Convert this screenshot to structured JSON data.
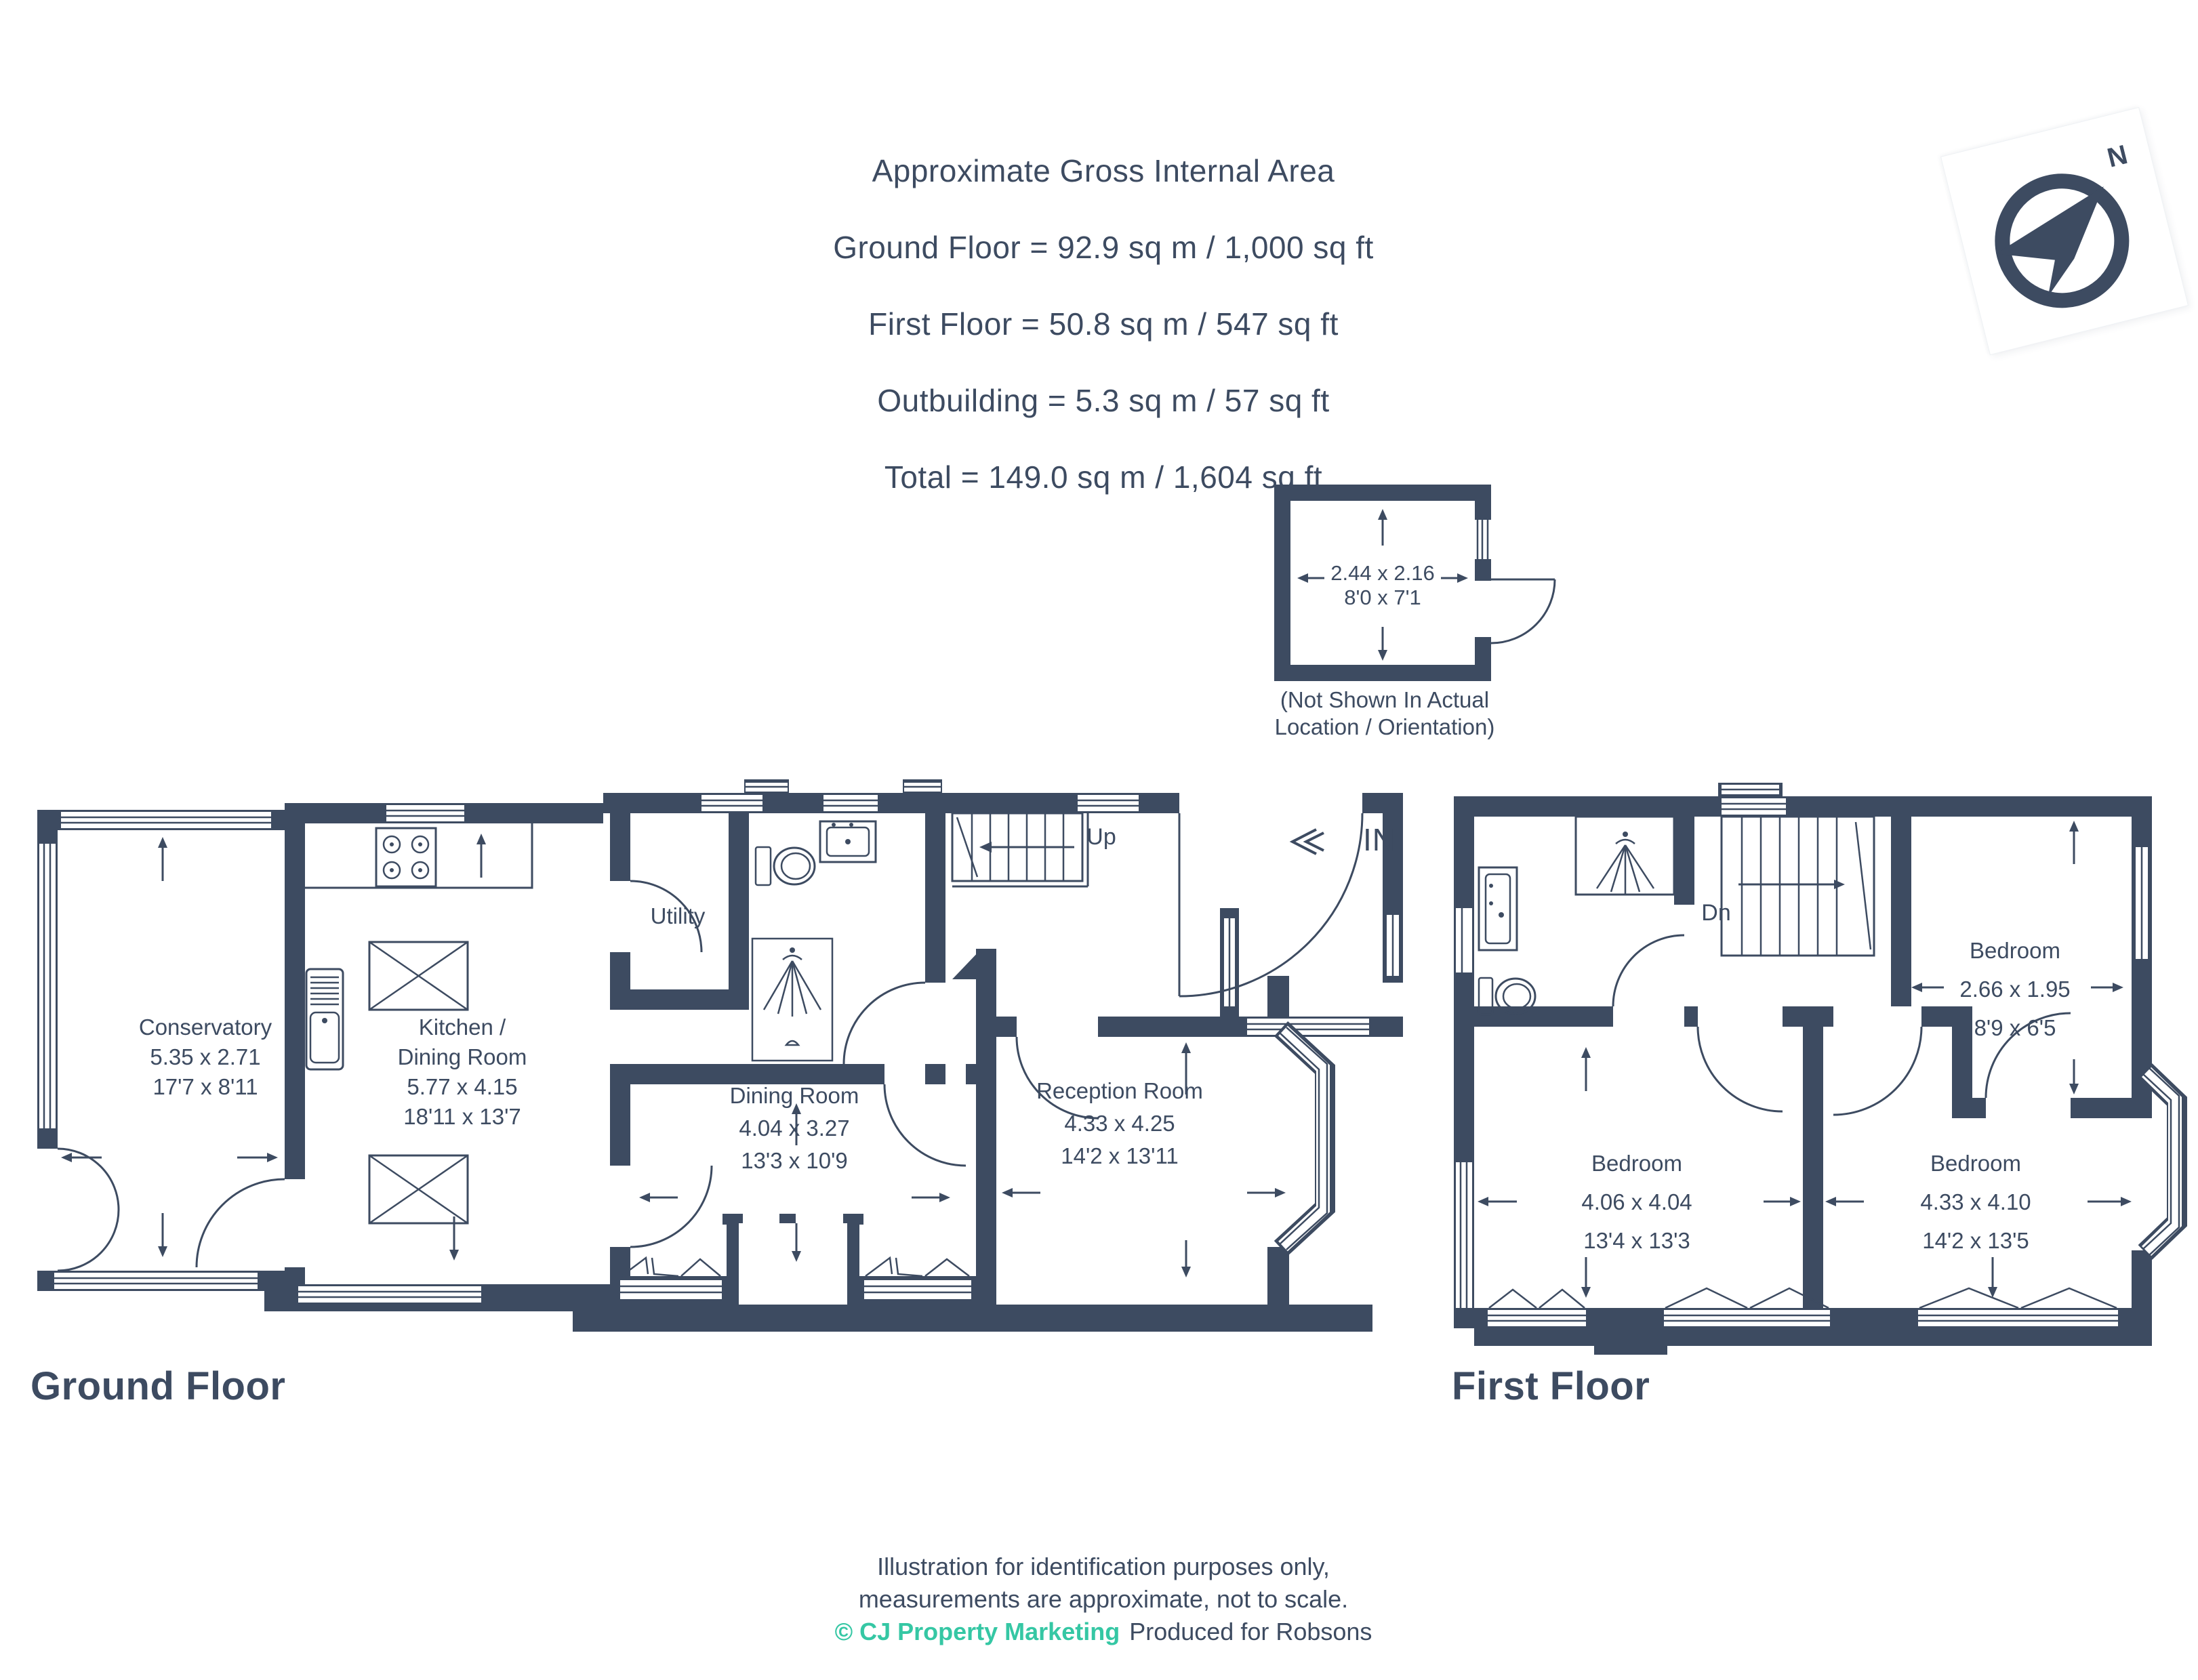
{
  "header": {
    "lines": [
      "Approximate Gross Internal Area",
      "Ground Floor = 92.9 sq m / 1,000 sq ft",
      "First Floor = 50.8 sq m / 547 sq ft",
      "Outbuilding = 5.3 sq m / 57 sq ft",
      "Total = 149.0 sq m / 1,604 sq ft"
    ]
  },
  "compass": {
    "north": "N"
  },
  "outbuilding": {
    "dims_metric": "2.44 x 2.16",
    "dims_imperial": "8'0 x 7'1",
    "note_line1": "(Not Shown In Actual",
    "note_line2": "Location / Orientation)"
  },
  "ground_floor": {
    "title": "Ground Floor",
    "conservatory": {
      "name": "Conservatory",
      "metric": "5.35 x 2.71",
      "imperial": "17'7 x 8'11"
    },
    "kitchen": {
      "name1": "Kitchen /",
      "name2": "Dining Room",
      "metric": "5.77 x 4.15",
      "imperial": "18'11 x 13'7"
    },
    "utility": {
      "name": "Utility"
    },
    "dining": {
      "name": "Dining Room",
      "metric": "4.04 x 3.27",
      "imperial": "13'3 x 10'9"
    },
    "reception": {
      "name": "Reception Room",
      "metric": "4.33 x 4.25",
      "imperial": "14'2 x 13'11"
    },
    "stairs_label": "Up",
    "entrance_label": "IN"
  },
  "first_floor": {
    "title": "First Floor",
    "bedroom_small": {
      "name": "Bedroom",
      "metric": "2.66 x 1.95",
      "imperial": "8'9 x 6'5"
    },
    "bedroom_left": {
      "name": "Bedroom",
      "metric": "4.06 x 4.04",
      "imperial": "13'4 x 13'3"
    },
    "bedroom_right": {
      "name": "Bedroom",
      "metric": "4.33 x 4.10",
      "imperial": "14'2 x 13'5"
    },
    "stairs_label": "Dn"
  },
  "footer": {
    "line1": "Illustration for identification purposes only,",
    "line2": "measurements are approximate, not to scale.",
    "copyright": "© CJ Property Marketing",
    "produced": "Produced for Robsons"
  },
  "colors": {
    "navy": "#3D4B61",
    "teal": "#35C7A4"
  }
}
